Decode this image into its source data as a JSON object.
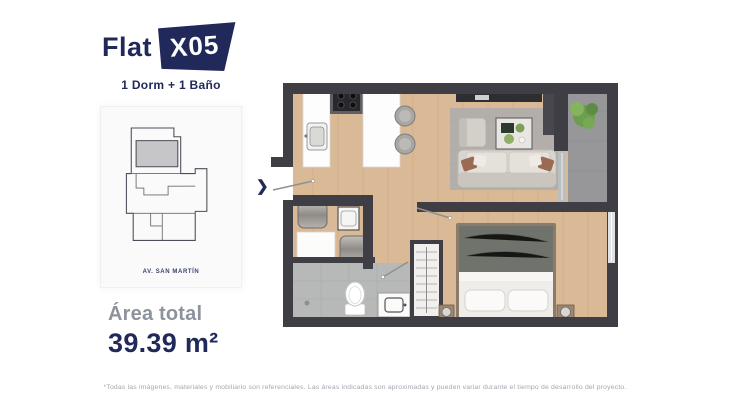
{
  "unit": {
    "name": "Flat",
    "code": "X05",
    "config": "1 Dorm + 1 Baño"
  },
  "key_plan": {
    "street": "AV. SAN MARTÍN"
  },
  "area": {
    "label": "Área total",
    "value": "39.39 m²"
  },
  "entrance": {
    "arrow_glyph": "❯"
  },
  "disclaimer": "*Todas las imágenes, materiales y mobiliario son referenciales. Las áreas indicadas son aproximadas y pueden variar durante el tiempo de desarrollo del proyecto.",
  "colors": {
    "navy": "#20295a",
    "gray-label": "#8d929c",
    "footer-gray": "#a2a6ae",
    "wall": "#3e3e44",
    "wood": "#d9b996",
    "tile": "#b7b8b8",
    "concrete": "#97979a",
    "rug": "#b3aeaa",
    "sofa": "#d9d5cf",
    "card-bg": "#fafafb"
  }
}
